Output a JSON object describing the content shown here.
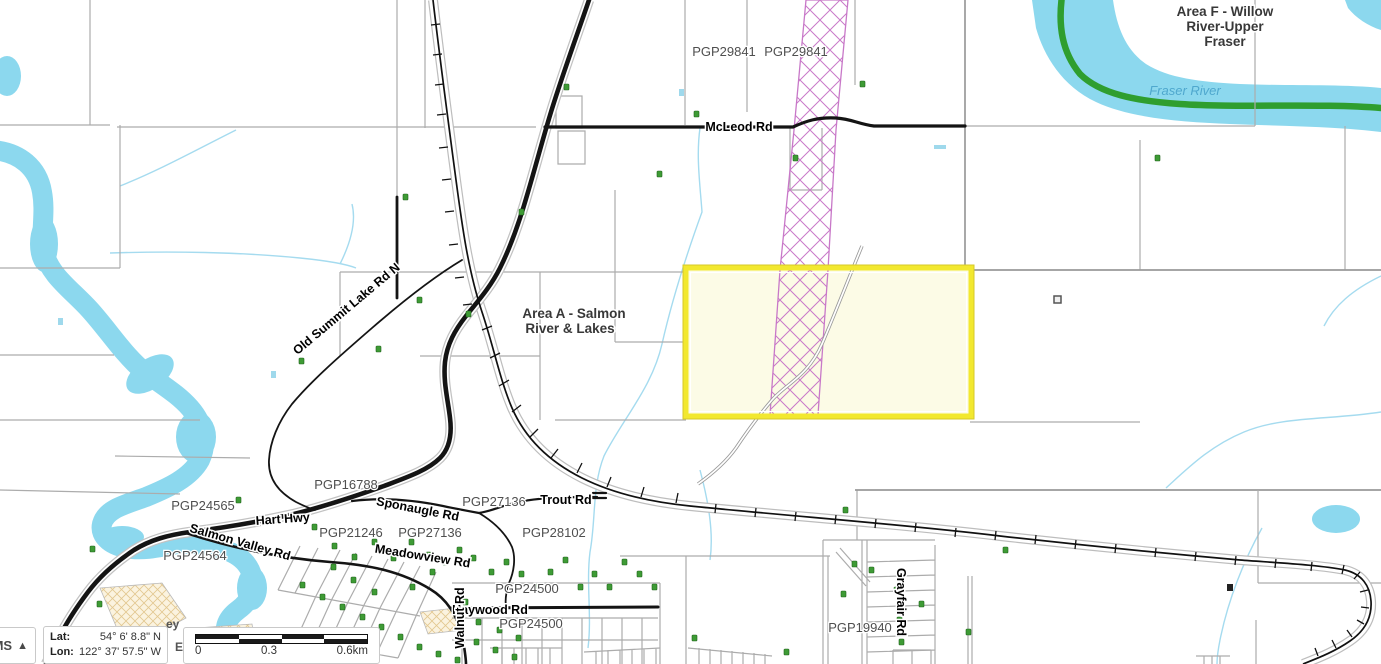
{
  "map": {
    "area_labels": {
      "area_f_line1": "Area F - Willow",
      "area_f_line2": "River-Upper",
      "area_f_line3": "Fraser",
      "area_a_line1": "Area A - Salmon",
      "area_a_line2": "River & Lakes"
    },
    "water_labels": {
      "fraser_river": "Fraser River"
    },
    "road_labels": {
      "mcleod": "McLeod Rd",
      "old_summit": "Old Summit Lake Rd N",
      "hart_hwy": "Hart Hwy",
      "salmon_valley": "Salmon Valley Rd",
      "sponaugle": "Sponaugle Rd",
      "meadowview": "Meadowview Rd",
      "trout": "Trout Rd",
      "haywood": "Haywood Rd",
      "walnut": "Walnut Rd",
      "grayfair": "Grayfair Rd"
    },
    "parcel_labels": {
      "pgp29841_a": "PGP29841",
      "pgp29841_b": "PGP29841",
      "pgp16788": "PGP16788",
      "pgp24565": "PGP24565",
      "pgp24564": "PGP24564",
      "pgp21246": "PGP21246",
      "pgp27136_a": "PGP27136",
      "pgp27136_b": "PGP27136",
      "pgp28102": "PGP28102",
      "pgp24500_a": "PGP24500",
      "pgp24500_b": "PGP24500",
      "pgp19940": "PGP19940"
    },
    "fragments": {
      "f1": "ey",
      "f2": "E"
    },
    "colors": {
      "water": "#8CD8EE",
      "creek": "#A5DBEF",
      "riparian_green": "#2F9E2F",
      "point_marker_green": "#3E9B35",
      "corridor_pink": "#C878C8",
      "highlight_fill": "#FCFBE6",
      "highlight_border": "#F2E82F",
      "road_black": "#141414",
      "parcel_gray": "#ACACAC"
    }
  },
  "hud": {
    "collapse_button": {
      "label": "OMS",
      "icon": "▲"
    },
    "coordinates": {
      "lat_label": "Lat:",
      "lat_value": "54° 6' 8.8\" N",
      "lon_label": "Lon:",
      "lon_value": "122° 37' 57.5\" W"
    },
    "scalebar": {
      "tick0": "0",
      "tick1": "0.3",
      "tick2": "0.6km"
    }
  }
}
